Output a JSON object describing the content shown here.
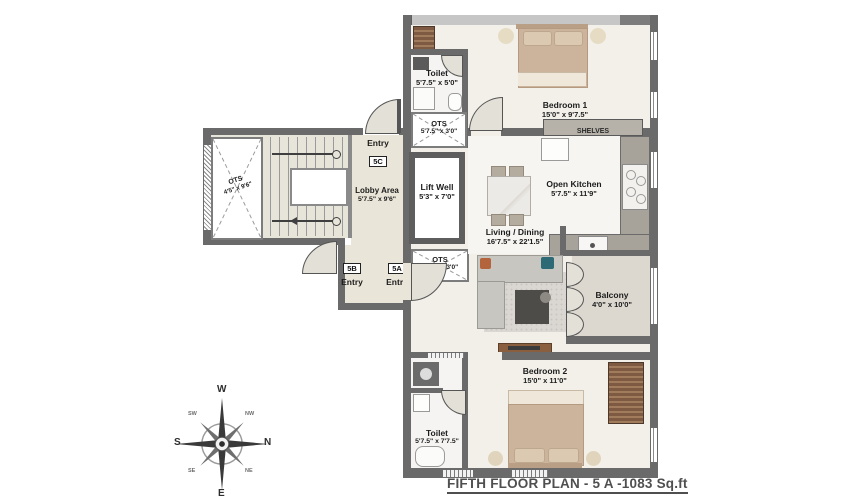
{
  "title": "FIFTH FLOOR PLAN - 5 A -1083 Sq.ft",
  "colors": {
    "wall": "#6a6a6a",
    "wall_light": "#c6c6c6",
    "floor_warm": "#f2efe8",
    "floor_lobby": "#eae5d9",
    "floor_balcony": "#dcd8cf",
    "bed": "#ccb49c",
    "wood": "#7d5a41",
    "counter": "#a7a39b",
    "text": "#1c1c1c"
  },
  "rooms": {
    "bedroom1": {
      "name": "Bedroom 1",
      "dims": "15'0\" x 9'7.5\""
    },
    "toilet_top": {
      "name": "Toilet",
      "dims": "5'7.5\" x 5'0\""
    },
    "ots_top": {
      "name": "OTS",
      "dims": "5'7.5\" x 3'0\""
    },
    "kitchen": {
      "name": "Open Kitchen",
      "dims": "5'7.5\" x 11'9\""
    },
    "lift_well": {
      "name": "Lift Well",
      "dims": "5'3\" x 7'0\""
    },
    "ots_mid": {
      "name": "OTS",
      "dims": "5'7.5\" x 3'0\""
    },
    "lobby": {
      "name": "Lobby Area",
      "dims": "5'7.5\" x 9'6\""
    },
    "ots_left": {
      "name": "OTS",
      "dims": "4'5\" x 9'6\""
    },
    "living": {
      "name": "Living / Dining",
      "dims": "16'7.5\" x 22'1.5\""
    },
    "balcony": {
      "name": "Balcony",
      "dims": "4'0\" x 10'0\""
    },
    "bedroom2": {
      "name": "Bedroom 2",
      "dims": "15'0\" x 11'0\""
    },
    "toilet_bottom": {
      "name": "Toilet",
      "dims": "5'7.5\" x 7'7.5\""
    }
  },
  "annotations": {
    "shelves": "SHELVES"
  },
  "entries": {
    "e5c": {
      "name": "Entry",
      "tag": "5C"
    },
    "e5b": {
      "name": "Entry",
      "tag": "5B"
    },
    "e5a": {
      "name": "Entry",
      "tag": "5A"
    }
  },
  "compass": {
    "w": "W",
    "n": "N",
    "e": "E",
    "s": "S",
    "nw": "NW",
    "ne": "NE",
    "sw": "SW",
    "se": "SE"
  }
}
